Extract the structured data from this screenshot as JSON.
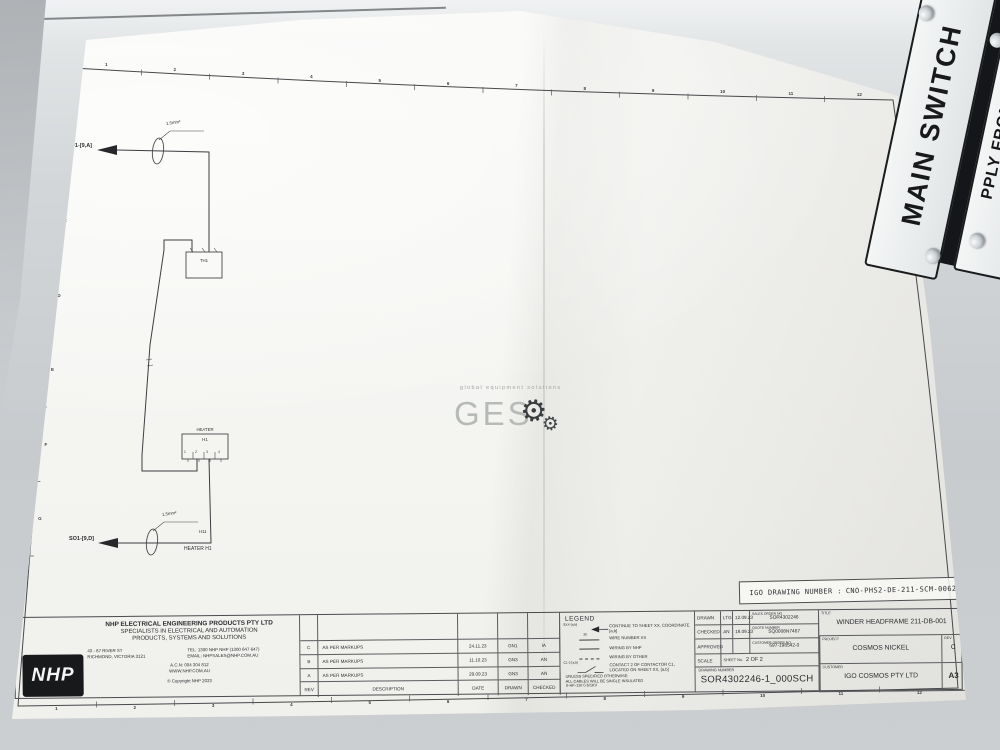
{
  "plates": {
    "main_switch_label": "MAIN SWITCH",
    "partial_label": "PPLY FROM"
  },
  "watermark": {
    "tagline": "global equipment solutions",
    "name": "GES",
    "gear_icon": "⚙"
  },
  "stamp": {
    "label": "IGO DRAWING NUMBER :",
    "number": "CNO-PHS2-DE-211-SCM-0062"
  },
  "schematic": {
    "source_top": "SO1-[9,A]",
    "source_bottom": "SO1-[9,D]",
    "wire_size_top": "1.5mm²",
    "wire_size_bottom": "1.5mm²",
    "thermostat_tag": "TH1",
    "heater_label": "HEATER",
    "heater_tag": "H1",
    "heater_terminals": [
      "1",
      "2",
      "3",
      "4"
    ],
    "wire_number": "H11",
    "heater_caption": "HEATER H1"
  },
  "border": {
    "rows": [
      "A",
      "B",
      "C",
      "D",
      "E",
      "F",
      "G"
    ],
    "cols": [
      "1",
      "2",
      "3",
      "4",
      "5",
      "6",
      "7",
      "8",
      "9",
      "10",
      "11",
      "12"
    ]
  },
  "company": {
    "logo": "NHP",
    "name": "NHP ELECTRICAL ENGINEERING PRODUCTS PTY LTD",
    "tagline1": "SPECIALISTS IN ELECTRICAL AND AUTOMATION",
    "tagline2": "PRODUCTS, SYSTEMS AND SOLUTIONS",
    "address1": "43 - 67 RIVER ST",
    "address2": "RICHMOND, VICTORIA 3121",
    "tel": "TEL: 1300 NHP NHP (1300 647 647)",
    "email": "EMAIL: NHPSALES@NHP.COM.AU",
    "acn": "A.C.N: 004 304 812",
    "web": "WWW.NHP.COM.AU",
    "copyright": "© Copyright NHP  2023"
  },
  "revisions": {
    "headers": {
      "rev": "REV",
      "description": "DESCRIPTION",
      "date": "DATE",
      "drawn": "DRAWN",
      "checked": "CHECKED"
    },
    "rows": [
      {
        "rev": "C",
        "description": "AS PER MARKUPS",
        "date": "24.11.23",
        "drawn": "GN1",
        "checked": "IA"
      },
      {
        "rev": "B",
        "description": "AS PER MARKUPS",
        "date": "11.10.23",
        "drawn": "GN3",
        "checked": "AN"
      },
      {
        "rev": "A",
        "description": "AS PER MARKUPS",
        "date": "29.09.23",
        "drawn": "GN3",
        "checked": "AN"
      }
    ]
  },
  "legend": {
    "title": "LEGEND",
    "items": [
      {
        "symbol": "SXX-[a,b]",
        "description": "CONTINUE TO SHEET XX, COORDINATE [a,b]"
      },
      {
        "symbol": "30",
        "description": "WIRE NUMBER XX"
      },
      {
        "symbol": "",
        "description": "WIRING BY NHP"
      },
      {
        "symbol": "",
        "description": "WIRING BY OTHER"
      },
      {
        "symbol": "C1-2 [a,b]",
        "description": "CONTACT 2 OF CONTACTOR C1, LOCATED ON SHEET XX, [a,b]"
      }
    ],
    "note1": "UNLESS SPECIFIED OTHERWISE:",
    "note2": "ALL CABLES WILL BE SINGLE INSULATED",
    "note3": "X-HF-110 0.6/1KV"
  },
  "approval": {
    "drawn_label": "DRAWN",
    "drawn_by": "LTG",
    "drawn_date": "12.09.23",
    "checked_label": "CHECKED",
    "checked_by": "AN",
    "checked_date": "18.09.23",
    "approved_label": "APPROVED",
    "sales_order_label": "SALES ORDER NO",
    "sales_order": "SOR4302246",
    "quote_label": "QUOTE NUMBER",
    "quote": "SQ0008N7467",
    "customer_order_label": "CUSTOMER ORDER NO",
    "customer_order": "697-198542-0",
    "scale_label": "SCALE",
    "sheet_label": "SHEET No.",
    "sheet": "2 OF 2",
    "drawing_number_label": "DRAWING NUMBER",
    "drawing_number": "SOR4302246-1_000SCH"
  },
  "info": {
    "title_label": "TITLE",
    "title": "WINDER HEADFRAME 211-DB-001",
    "project_label": "PROJECT",
    "project": "COSMOS NICKEL",
    "customer_label": "CUSTOMER",
    "customer": "IGO COSMOS PTY LTD",
    "rev_label": "REV",
    "rev": "C",
    "size": "A3"
  }
}
